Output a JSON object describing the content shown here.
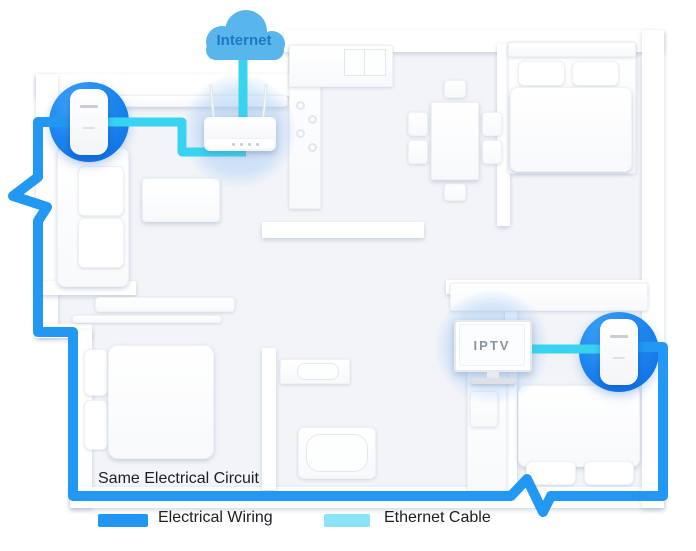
{
  "diagram": {
    "cloud": {
      "label": "Internet"
    },
    "tv": {
      "label": "IPTV"
    },
    "circuit_label": "Same Electrical Circuit",
    "legend": [
      {
        "label": "Electrical Wiring",
        "color": "#2196F3"
      },
      {
        "label": "Ethernet Cable",
        "color": "#8BE3F8"
      }
    ],
    "colors": {
      "cloud_fill": "#58B6ED",
      "internet_text": "#1E78C2",
      "electrical_wire": "#2298F3",
      "ethernet_cable": "#38D3F0",
      "adapter_circle_top": "#3FA7F8",
      "adapter_circle_bottom": "#0B6CE0",
      "iptv_text": "#8A94A0",
      "floor": "#F2F4F8"
    },
    "devices": {
      "cloud": "internet-cloud",
      "router": "wireless-router",
      "adapter_left": "powerline-adapter",
      "adapter_right": "powerline-adapter",
      "tv": "iptv-television"
    }
  }
}
